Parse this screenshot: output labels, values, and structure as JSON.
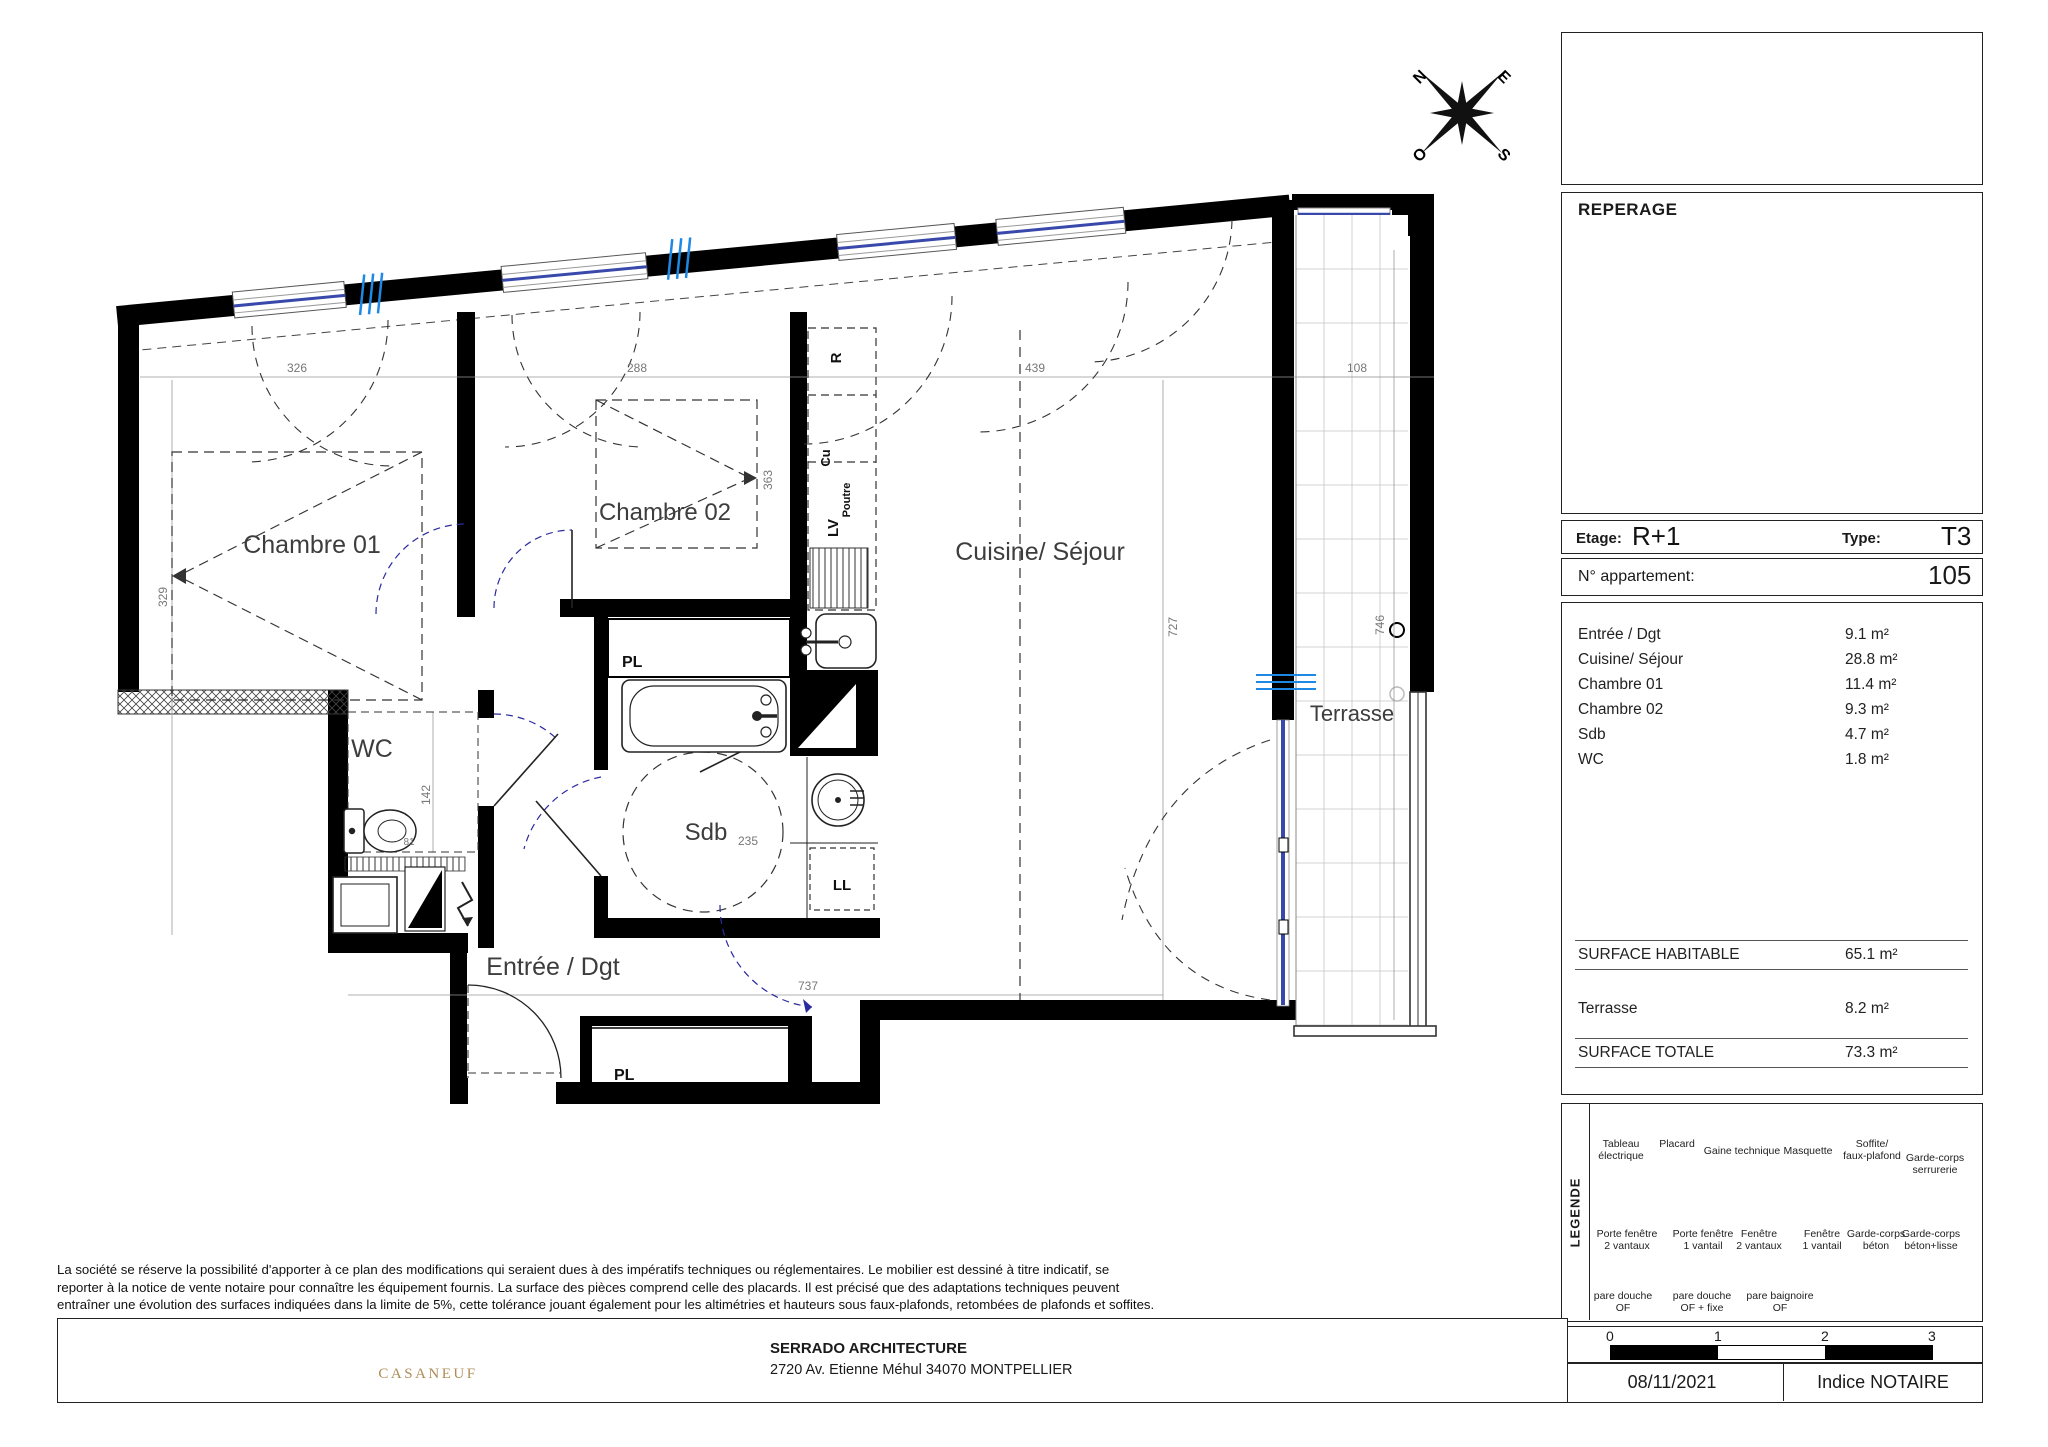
{
  "colors": {
    "accent_red": "#E8231D",
    "window_blue": "#3949AB",
    "tick_blue": "#1E88E5",
    "door_arc_navy": "#2B2BA0",
    "casaneuf_gold": "#AE8D55",
    "logo_gray": "#6B6B6B"
  },
  "compass": {
    "n": "N",
    "e": "E",
    "s": "S",
    "o": "O"
  },
  "plan": {
    "rooms": {
      "chambre01": "Chambre 01",
      "chambre02": "Chambre 02",
      "cuisine_sejour": "Cuisine/ Séjour",
      "wc": "WC",
      "sdb": "Sdb",
      "entree": "Entrée / Dgt",
      "terrasse": "Terrasse"
    },
    "equipment": {
      "placard_sdb": "PL",
      "placard_entree": "PL",
      "lave_vaisselle": "LV",
      "refrigerateur": "R",
      "cuisson": "Cu",
      "poutre": "Poutre",
      "lave_linge": "LL"
    },
    "dims": {
      "chambre01_l": "326",
      "chambre01_w": "329",
      "chambre02_l": "288",
      "chambre02_w": "363",
      "sejour_l": "439",
      "sejour_w": "727",
      "terrasse_l": "108",
      "terrasse_w": "746",
      "wc_w": "142",
      "wc_l": "81",
      "sdb_l": "235",
      "entree_l": "737"
    }
  },
  "titleblock": {
    "reperage": "REPERAGE",
    "etage_label": "Etage:",
    "etage_value": "R+1",
    "type_label": "Type:",
    "type_value": "T3",
    "apartment_label": "N° appartement:",
    "apartment_value": "105"
  },
  "surfaces": {
    "rows": [
      {
        "label": "Entrée / Dgt",
        "value": "9.1 m²"
      },
      {
        "label": "Cuisine/ Séjour",
        "value": "28.8 m²"
      },
      {
        "label": "Chambre 01",
        "value": "11.4 m²"
      },
      {
        "label": "Chambre 02",
        "value": "9.3 m²"
      },
      {
        "label": "Sdb",
        "value": "4.7 m²"
      },
      {
        "label": "WC",
        "value": "1.8 m²"
      }
    ],
    "habitable_label": "SURFACE HABITABLE",
    "habitable_value": "65.1 m²",
    "terrasse_label": "Terrasse",
    "terrasse_value": "8.2 m²",
    "totale_label": "SURFACE TOTALE",
    "totale_value": "73.3 m²"
  },
  "legend": {
    "title": "LEGENDE",
    "row1": [
      {
        "label": "Tableau\nélectrique"
      },
      {
        "label": "Placard",
        "glyph": "Pl"
      },
      {
        "label": "Gaine technique"
      },
      {
        "label": "Masquette"
      },
      {
        "label": "Soffite/\nfaux-plafond"
      },
      {
        "label": "Garde-corps\nserrurerie"
      }
    ],
    "row2": [
      {
        "label": "Porte fenêtre\n2 vantaux"
      },
      {
        "label": "Porte fenêtre\n1 vantail"
      },
      {
        "label": "Fenêtre\n2 vantaux"
      },
      {
        "label": "Fenêtre\n1 vantail"
      },
      {
        "label": "Garde-corps\nbéton"
      },
      {
        "label": "Garde-corps\nbéton+lisse"
      }
    ],
    "row3": [
      {
        "label": "pare douche\nOF"
      },
      {
        "label": "pare douche\nOF + fixe"
      },
      {
        "label": "pare baignoire\nOF"
      }
    ]
  },
  "scalebar": {
    "t0": "0",
    "t1": "1",
    "t2": "2",
    "t3": "3"
  },
  "footer": {
    "disclaimer": "La société se réserve la possibilité d'apporter à ce plan des modifications qui seraient dues à des impératifs techniques ou réglementaires. Le mobilier est dessiné à titre indicatif, se reporter à la notice de vente notaire pour connaître les équipement fournis. La surface des pièces comprend celle des placards. Il est précisé que des adaptations techniques peuvent entraîner une évolution des surfaces indiquées dans la limite de 5%, cette tolérance jouant également pour les altimétries et hauteurs sous faux-plafonds, retombées de plafonds et soffites.",
    "brand": "CASANEUF",
    "architect_name": "SERRADO ARCHITECTURE",
    "architect_address": "2720 Av. Etienne Méhul 34070 MONTPELLIER",
    "date": "08/11/2021",
    "indice": "Indice NOTAIRE"
  }
}
